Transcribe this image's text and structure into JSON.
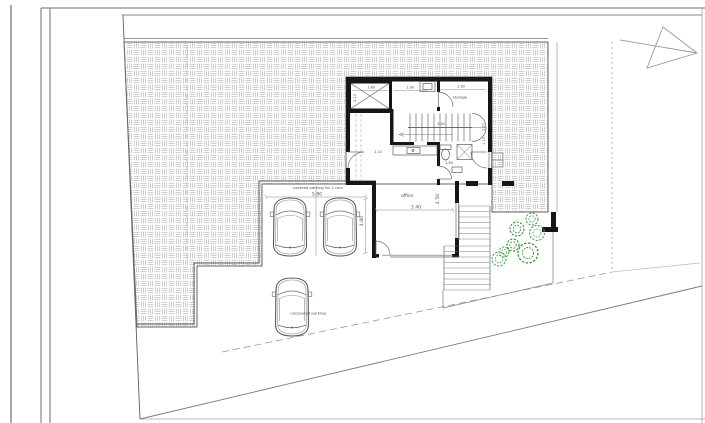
{
  "labels": {
    "office": "office",
    "storage": "storage",
    "covered_parking": "covered parking for 2 cars",
    "uncovered_parking": "uncovered parking"
  },
  "dims": {
    "elevator_width": "1.80",
    "elevator_depth": "2.10",
    "hall_width": "1.90",
    "storage_width": "2.30",
    "stair_length": "3.40",
    "stair_rise": "2.20",
    "stair_width": "1.10",
    "entry_door": "1.10",
    "wc_width": "1.60",
    "office_width": "3.40",
    "office_depth": "4.50",
    "parking_width": "5.80",
    "parking_depth": "4.80"
  },
  "colors": {
    "line": "#5a5a5a",
    "wall": "#161616",
    "hatch_line": "#c9c9c9",
    "tree_green": "#3fa03f",
    "background": "#ffffff"
  }
}
